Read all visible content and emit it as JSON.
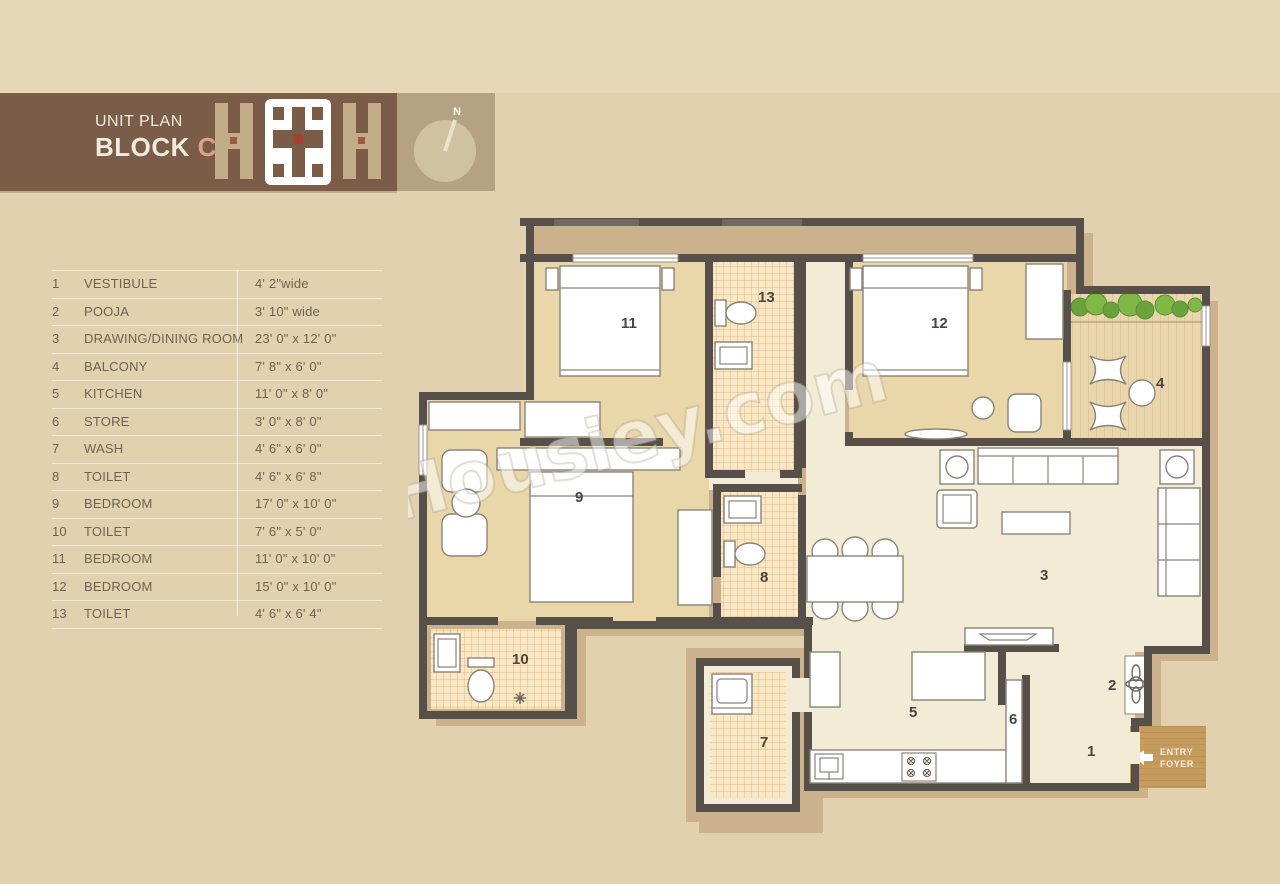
{
  "header": {
    "title_line1": "UNIT PLAN",
    "title_line2": "BLOCK",
    "block_letter": "C"
  },
  "compass": {
    "north_label": "N"
  },
  "legend": {
    "rows": [
      {
        "num": "1",
        "name": "VESTIBULE",
        "size": "4' 2\"wide"
      },
      {
        "num": "2",
        "name": "POOJA",
        "size": "3' 10\" wide"
      },
      {
        "num": "3",
        "name": "DRAWING/DINING ROOM",
        "size": "23' 0\" x 12' 0\""
      },
      {
        "num": "4",
        "name": "BALCONY",
        "size": "7' 8\" x 6' 0\""
      },
      {
        "num": "5",
        "name": "KITCHEN",
        "size": "11' 0\" x 8' 0\""
      },
      {
        "num": "6",
        "name": "STORE",
        "size": "3' 0\" x 8' 0\""
      },
      {
        "num": "7",
        "name": "WASH",
        "size": "4' 6\" x 6' 0\""
      },
      {
        "num": "8",
        "name": "TOILET",
        "size": "4' 6\" x 6' 8\""
      },
      {
        "num": "9",
        "name": "BEDROOM",
        "size": "17' 0\" x 10' 0\""
      },
      {
        "num": "10",
        "name": "TOILET",
        "size": "7' 6\" x 5' 0\""
      },
      {
        "num": "11",
        "name": "BEDROOM",
        "size": "11' 0\" x 10' 0\""
      },
      {
        "num": "12",
        "name": "BEDROOM",
        "size": "15' 0\" x 10' 0\""
      },
      {
        "num": "13",
        "name": "TOILET",
        "size": "4' 6\" x 6' 4\""
      }
    ]
  },
  "plan": {
    "watermark": "Housiey.com",
    "entry_foyer": {
      "line1": "ENTRY",
      "line2": "FOYER"
    },
    "labels": {
      "vestibule": "1",
      "pooja": "2",
      "drawing_dining": "3",
      "balcony": "4",
      "kitchen": "5",
      "store": "6",
      "wash": "7",
      "toilet8": "8",
      "bedroom9": "9",
      "toilet10": "10",
      "bedroom11": "11",
      "bedroom12": "12",
      "toilet13": "13"
    }
  },
  "colors": {
    "background": "#e1d1af",
    "header_brown": "#7b5c49",
    "block_letter_accent": "#dca288",
    "wall": "#57504a",
    "plan_band": "#cbb28c",
    "bedroom_fill": "#e9d7a9",
    "living_fill": "#f2ebd6",
    "tile_fill": "#f8e8c5",
    "foyer_wood": "#c69b5e",
    "plant_green": "#7fb847"
  }
}
